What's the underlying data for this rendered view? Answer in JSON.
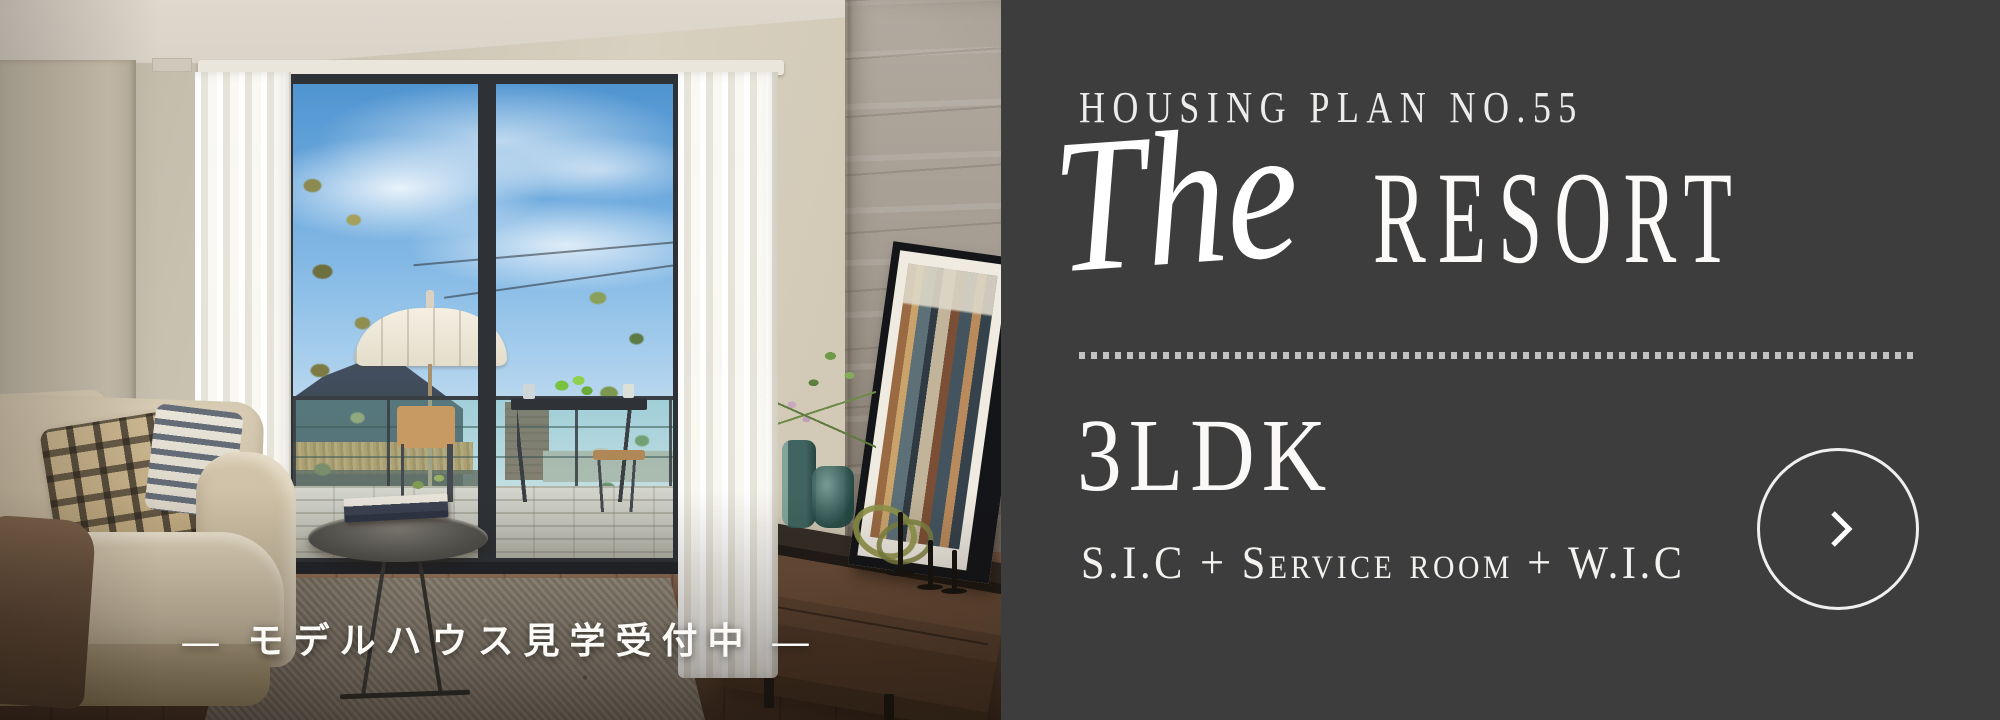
{
  "panel": {
    "background": "#3d3d3d",
    "text_color": "#f6f5f2",
    "plan_label": "HOUSING PLAN NO.55",
    "title": {
      "script": "The",
      "main": "RESORT"
    },
    "layout": "3LDK",
    "layout_detail": "S.I.C + Service room + W.I.C",
    "next_button": {
      "icon": "chevron-right"
    }
  },
  "photo": {
    "caption": "— モデルハウス見学受付中 —"
  }
}
